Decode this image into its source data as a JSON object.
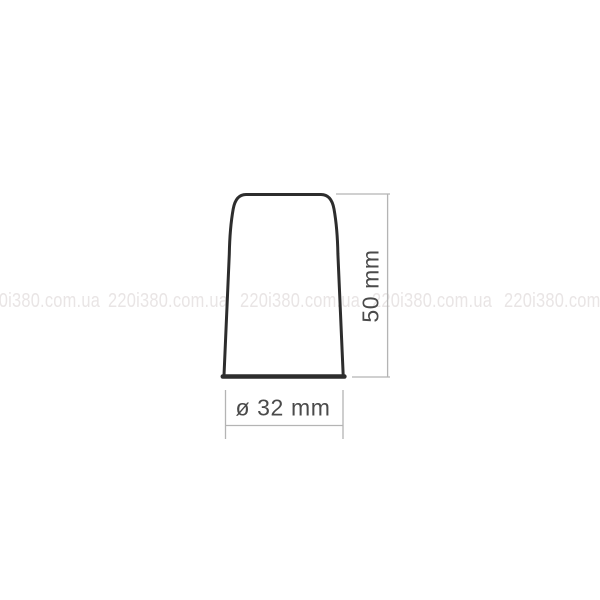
{
  "watermark": {
    "text": "220i380.com.ua",
    "color": "#e9e5e5"
  },
  "dimensions": {
    "height": {
      "label": "50 mm",
      "value_mm": 50
    },
    "diameter": {
      "label": "ø 32 mm",
      "value_mm": 32
    }
  },
  "colors": {
    "background": "#ffffff",
    "outline": "#2d2d2d",
    "dimension_lines": "#b4b4b4",
    "dimension_text": "#4a4a4a"
  }
}
